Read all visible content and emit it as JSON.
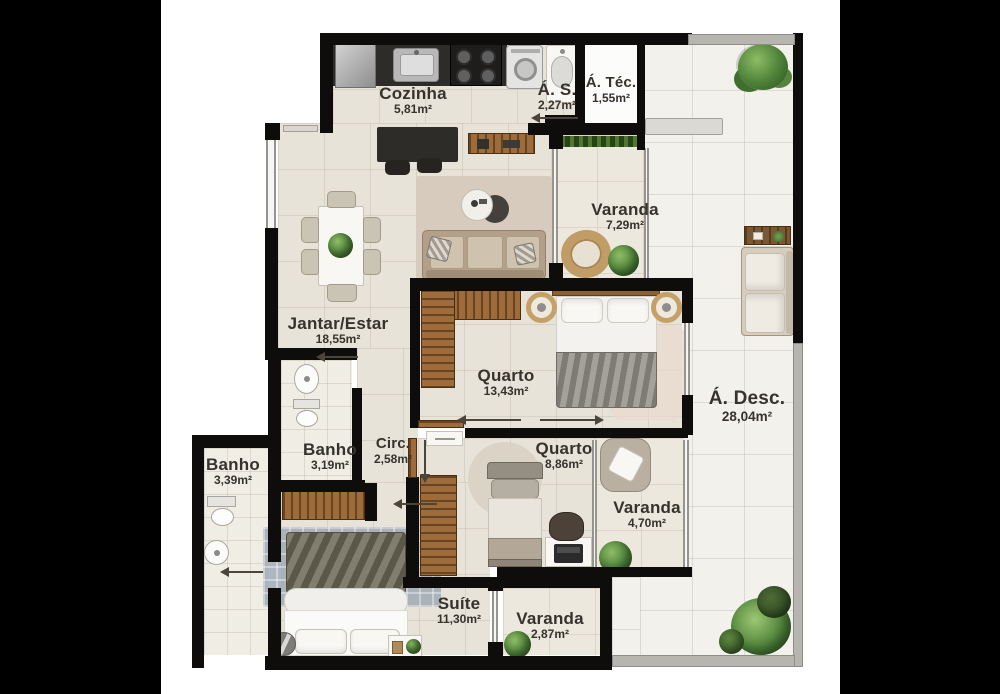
{
  "plan": {
    "rooms": [
      {
        "id": "cozinha",
        "name": "Cozinha",
        "area": "5,81m²"
      },
      {
        "id": "area-servico",
        "name": "Á. S.",
        "area": "2,27m²"
      },
      {
        "id": "area-tecnica",
        "name": "Á. Téc.",
        "area": "1,55m²"
      },
      {
        "id": "varanda-norte",
        "name": "Varanda",
        "area": "7,29m²"
      },
      {
        "id": "jantar-estar",
        "name": "Jantar/Estar",
        "area": "18,55m²"
      },
      {
        "id": "quarto-1",
        "name": "Quarto",
        "area": "13,43m²"
      },
      {
        "id": "area-descoberta",
        "name": "Á. Desc.",
        "area": "28,04m²"
      },
      {
        "id": "banho-1",
        "name": "Banho",
        "area": "3,19m²"
      },
      {
        "id": "circulacao",
        "name": "Circ.",
        "area": "2,58m²"
      },
      {
        "id": "banho-2",
        "name": "Banho",
        "area": "3,39m²"
      },
      {
        "id": "quarto-2",
        "name": "Quarto",
        "area": "8,86m²"
      },
      {
        "id": "varanda-leste",
        "name": "Varanda",
        "area": "4,70m²"
      },
      {
        "id": "suite",
        "name": "Suíte",
        "area": "11,30m²"
      },
      {
        "id": "varanda-sul",
        "name": "Varanda",
        "area": "2,87m²"
      }
    ],
    "colors": {
      "wall": "#0e0d0b",
      "interior_floor": "#e8e3d8",
      "terrace_floor": "#f2f1ec",
      "parapet": "#b7b5b0",
      "wood": "#9e6c3a",
      "greenery": "#4f833a",
      "label_text": "#36322c",
      "letterbox": "#000000"
    }
  }
}
